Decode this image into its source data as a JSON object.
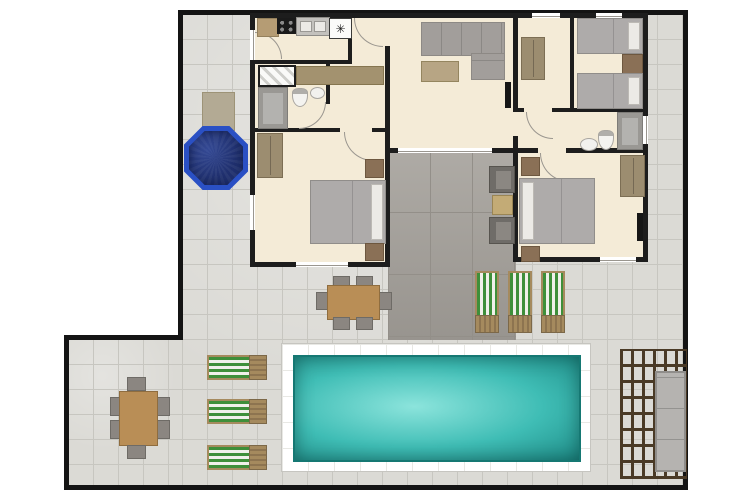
{
  "page": {
    "type": "villa-floor-plan",
    "description": "Top-down floor plan of a villa with interior rooms, inner courtyard, terrace, hot tub, swimming pool and pergola lounge"
  },
  "icons": {
    "freezer": "✳"
  },
  "colors": {
    "outside": "#ffffff",
    "boundary": "#141414",
    "wall": "#1d1d1d",
    "patio_tile": "#dbdad5",
    "patio_line": "#c7c6c0",
    "courtyard_tile": "#a5a19b",
    "courtyard_line": "#938f89",
    "floor": "#f4ebd7",
    "window": "#ffffff",
    "window_line": "#9a968f",
    "door_arc": "#9a968f",
    "wood_table": "#b98e56",
    "counter": "#b59c74",
    "console": "#a3926f",
    "wardrobe": "#9c8d70",
    "nightstand": "#8a7056",
    "sofa": "#a29e9b",
    "coffee_table": "#b7a584",
    "bed_blanket": "#aeabaa",
    "pillow": "#eceae6",
    "chair_gray": "#8b8681",
    "chair_dark": "#6f6c68",
    "appliance": "#9a9894",
    "stove": "#1a1a1a",
    "fridge": "#fbfbf9",
    "tv": "#161616",
    "pool_border": "#ffffff",
    "pool_light": "#8ce4dc",
    "pool_mid": "#3fbdb5",
    "pool_deep": "#1e8c87",
    "hottub_rim": "#2a50c4",
    "hottub_water": "#20306e",
    "hottub_step": "#b3aa94",
    "lounger_green": "#3e8f3a",
    "lounger_white": "#f0f0ea",
    "lounger_wood": "#a58a5e",
    "pergola_beam": "#4a3a26",
    "pergola_sofa": "#b5b3b0"
  },
  "inventory": {
    "rooms": [
      {
        "name": "kitchen",
        "items": [
          "counter",
          "stove",
          "double-sink",
          "fridge-freezer"
        ]
      },
      {
        "name": "living-room",
        "items": [
          "l-shaped-sofa",
          "coffee-table",
          "wall-tv"
        ]
      },
      {
        "name": "hallway-bathroom",
        "items": [
          "hatched-shower",
          "washing-machine",
          "toilet",
          "sink",
          "console"
        ]
      },
      {
        "name": "dressing-hall",
        "items": [
          "wardrobe"
        ]
      },
      {
        "name": "twin-bedroom",
        "items": [
          "single-bed",
          "single-bed",
          "nightstand"
        ]
      },
      {
        "name": "bathroom-right",
        "items": [
          "shower",
          "toilet",
          "sink"
        ]
      },
      {
        "name": "double-bedroom-left",
        "items": [
          "double-bed",
          "wardrobe",
          "nightstand",
          "nightstand"
        ]
      },
      {
        "name": "double-bedroom-right",
        "items": [
          "double-bed",
          "wardrobe",
          "nightstand",
          "nightstand",
          "wall-tv"
        ]
      },
      {
        "name": "inner-courtyard",
        "items": [
          "armchair",
          "armchair",
          "side-table"
        ]
      }
    ],
    "outdoor": [
      {
        "name": "hot-tub",
        "shape": "octagon"
      },
      {
        "name": "swimming-pool",
        "shape": "rectangle"
      },
      {
        "name": "dining-table-south",
        "chairs": 6
      },
      {
        "name": "dining-table-west",
        "chairs": 6
      },
      {
        "name": "sun-loungers-south",
        "count": 3
      },
      {
        "name": "sun-loungers-west",
        "count": 3
      },
      {
        "name": "pergola-lounge",
        "items": [
          "outdoor-sofa"
        ]
      }
    ]
  }
}
